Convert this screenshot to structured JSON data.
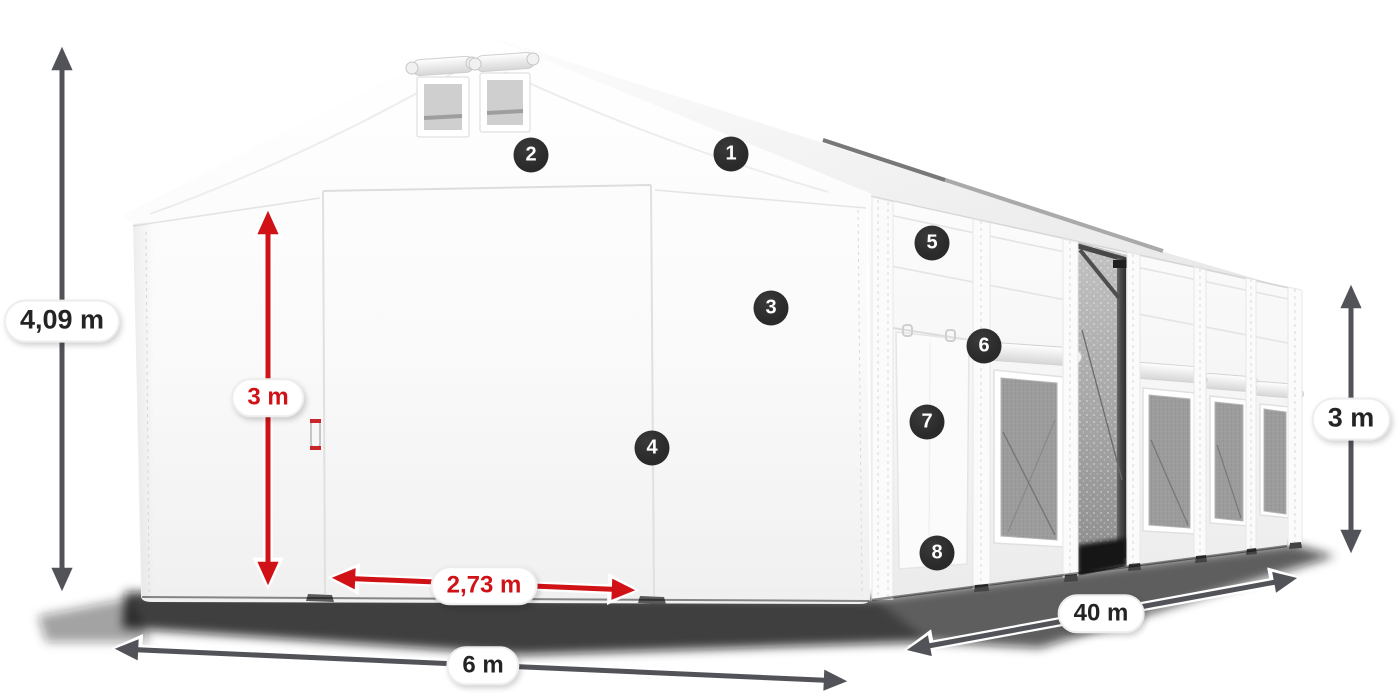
{
  "diagram": {
    "name": "Storage tent dimension diagram",
    "markers": [
      {
        "label": "1"
      },
      {
        "label": "2"
      },
      {
        "label": "3"
      },
      {
        "label": "4"
      },
      {
        "label": "5"
      },
      {
        "label": "6"
      },
      {
        "label": "7"
      },
      {
        "label": "8"
      }
    ],
    "dimension_labels": {
      "total_height": "4,09 m",
      "entrance_height": "3 m",
      "entrance_width": "2,73 m",
      "tent_width": "6 m",
      "tent_length": "40 m",
      "side_height": "3 m"
    },
    "colors": {
      "dimension-red": "#d01217",
      "dimension-gray": "#515358",
      "marker-bg": "#2a2a2a",
      "marker-text": "#ffffff",
      "label-text": "#242424"
    }
  }
}
